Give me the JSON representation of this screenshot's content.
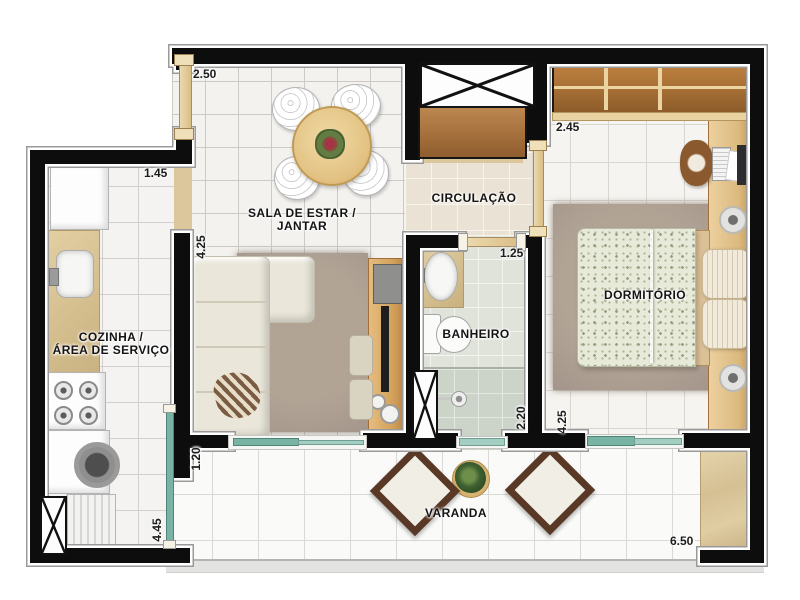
{
  "rooms": {
    "living": {
      "line1": "SALA DE ESTAR /",
      "line2": "JANTAR"
    },
    "kitchen": {
      "line1": "COZINHA /",
      "line2": "ÁREA DE SERVIÇO"
    },
    "circulation": {
      "label": "CIRCULAÇÃO"
    },
    "bathroom": {
      "label": "BANHEIRO"
    },
    "bedroom": {
      "label": "DORMITÓRIO"
    },
    "balcony": {
      "label": "VARANDA"
    }
  },
  "dimensions": {
    "living_entry_width": "2.50",
    "kitchen_passage_width": "1.45",
    "living_depth": "4.25",
    "wardrobe_width": "2.45",
    "bedroom_entry_width": "1.25",
    "bathroom_depth": "2.20",
    "bedroom_depth": "4.25",
    "balcony_return": "1.20",
    "service_area_depth": "4.45",
    "balcony_width": "6.50"
  },
  "colors": {
    "wall": "#0d0d0d",
    "glass": "#79b3a4",
    "wood": "#a9743f",
    "counter": "#d3bd8d",
    "floor_tile": "#f3f2ef"
  }
}
